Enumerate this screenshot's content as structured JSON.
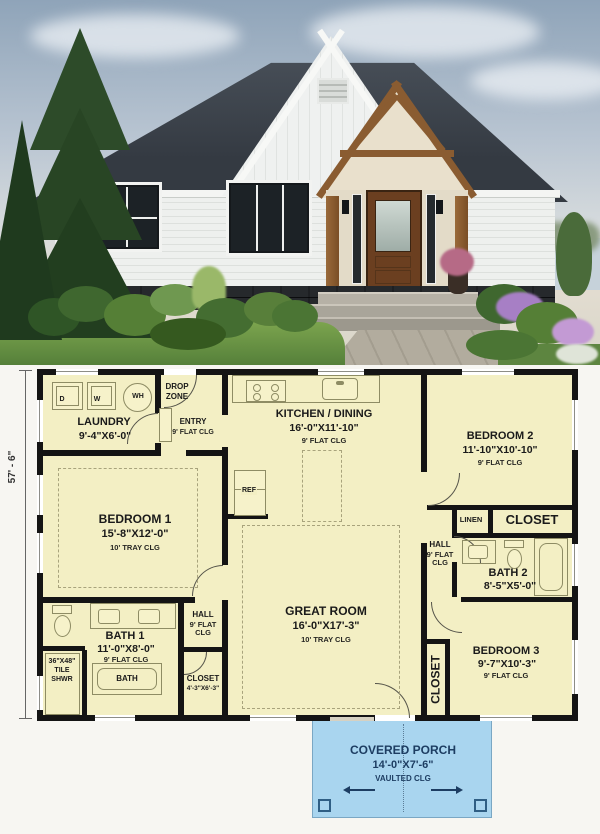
{
  "plan": {
    "overall_dim_left": "57' - 6\"",
    "laundry": {
      "name": "LAUNDRY",
      "dims": "9'-4\"X6'-0\""
    },
    "drop_zone": {
      "line1": "DROP",
      "line2": "ZONE"
    },
    "entry": {
      "name": "ENTRY",
      "clg": "9' FLAT CLG"
    },
    "kitchen": {
      "name": "KITCHEN / DINING",
      "dims": "16'-0\"X11'-10\"",
      "clg": "9' FLAT CLG"
    },
    "bedroom2": {
      "name": "BEDROOM 2",
      "dims": "11'-10\"X10'-10\"",
      "clg": "9' FLAT CLG"
    },
    "linen": {
      "name": "LINEN"
    },
    "closet2": {
      "name": "CLOSET"
    },
    "hall_right": {
      "name": "HALL",
      "clg": "9' FLAT CLG"
    },
    "bath2": {
      "name": "BATH 2",
      "dims": "8'-5\"X5'-0\""
    },
    "bedroom3": {
      "name": "BEDROOM 3",
      "dims": "9'-7\"X10'-3\"",
      "clg": "9' FLAT CLG"
    },
    "closet3": {
      "name": "CLOSET"
    },
    "great_room": {
      "name": "GREAT ROOM",
      "dims": "16'-0\"X17'-3\"",
      "clg": "10' TRAY CLG"
    },
    "bedroom1": {
      "name": "BEDROOM 1",
      "dims": "15'-8\"X12'-0\"",
      "clg": "10' TRAY CLG"
    },
    "hall_left": {
      "name": "HALL",
      "clg": "9' FLAT CLG"
    },
    "bath1": {
      "name": "BATH 1",
      "dims": "11'-0\"X8'-0\"",
      "clg": "9' FLAT CLG"
    },
    "closet1": {
      "name": "CLOSET",
      "dims": "4'-3\"X6'-3\""
    },
    "tile_shower": {
      "line1": "36\"X48\"",
      "line2": "TILE",
      "line3": "SHWR"
    },
    "tub_label": "BATH",
    "appliances": {
      "dryer": "D",
      "washer": "W",
      "water_heater": "WH",
      "fridge": "REF"
    },
    "porch": {
      "name": "COVERED PORCH",
      "dims": "14'-0\"X7'-6\"",
      "clg": "VAULTED CLG"
    }
  },
  "colors": {
    "wall": "#141414",
    "room_fill": "#f3efc4",
    "paper": "#f7f6f2",
    "fixture_line": "#8e8c64",
    "porch_fill": "#a9d5ef",
    "porch_text": "#1d3d62",
    "roof": "#3a4046",
    "siding": "#eef0ee",
    "timber": "#8a5c31",
    "door_wood": "#6b3f20",
    "lawn": "#6f9b45",
    "sky": "#8fa4b9"
  }
}
